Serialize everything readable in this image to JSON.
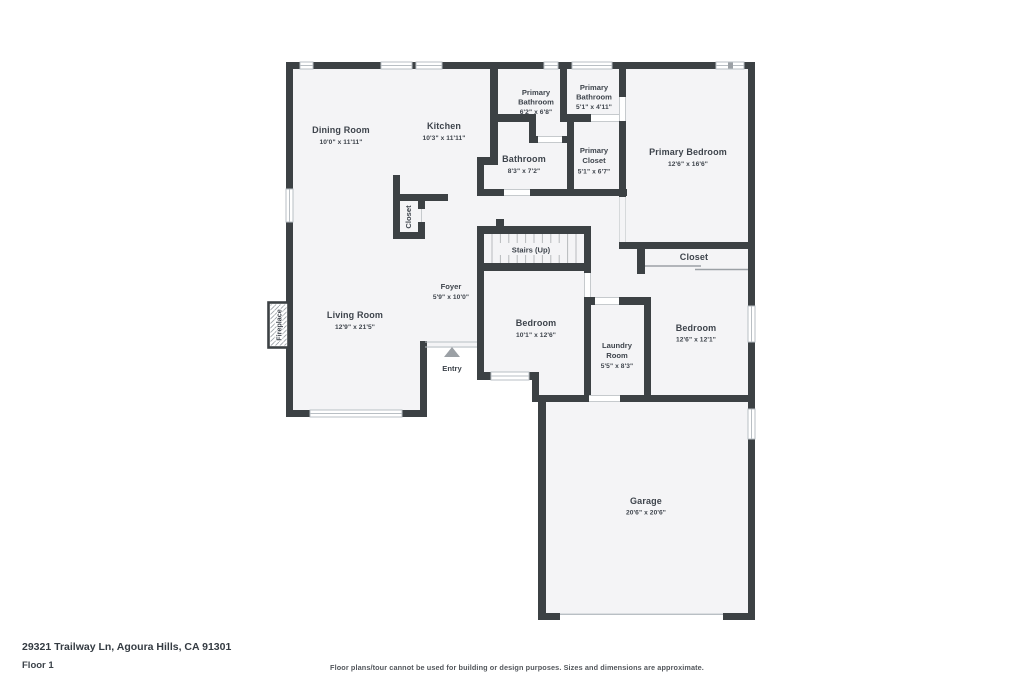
{
  "footer": {
    "address": "29321 Trailway Ln, Agoura Hills, CA 91301",
    "floor_label": "Floor 1",
    "disclaimer": "Floor plans/tour cannot be used for building or design purposes. Sizes and dimensions are approximate."
  },
  "colors": {
    "wall": "#3c4144",
    "floor": "#f4f4f6",
    "label_text": "#3e444c",
    "window_line": "#b9bfc4",
    "entry_arrow": "#9ba0a5"
  },
  "rooms": {
    "dining": {
      "name": "Dining Room",
      "dims": "10'0\" x 11'11\""
    },
    "kitchen": {
      "name": "Kitchen",
      "dims": "10'3\" x 11'11\""
    },
    "primary_bathroom_1": {
      "name_line1": "Primary",
      "name_line2": "Bathroom",
      "dims": "6'2\" x 6'8\""
    },
    "primary_bathroom_2": {
      "name_line1": "Primary",
      "name_line2": "Bathroom",
      "dims": "5'1\" x 4'11\""
    },
    "bathroom": {
      "name": "Bathroom",
      "dims": "8'3\" x 7'2\""
    },
    "primary_closet": {
      "name_line1": "Primary",
      "name_line2": "Closet",
      "dims": "5'1\" x 6'7\""
    },
    "primary_bedroom": {
      "name": "Primary Bedroom",
      "dims": "12'6\" x 16'6\""
    },
    "kitchen_closet": {
      "name": "Closet"
    },
    "stairs": {
      "name": "Stairs (Up)"
    },
    "bedroom_closet": {
      "name": "Closet"
    },
    "foyer": {
      "name": "Foyer",
      "dims": "5'9\" x 10'0\""
    },
    "living": {
      "name": "Living Room",
      "dims": "12'9\" x 21'5\""
    },
    "bedroom_1": {
      "name": "Bedroom",
      "dims": "10'1\" x 12'6\""
    },
    "laundry": {
      "name_line1": "Laundry",
      "name_line2": "Room",
      "dims": "5'5\" x 8'3\""
    },
    "bedroom_2": {
      "name": "Bedroom",
      "dims": "12'6\" x 12'1\""
    },
    "entry": {
      "name": "Entry"
    },
    "garage": {
      "name": "Garage",
      "dims": "20'6\" x 20'6\""
    },
    "fireplace": {
      "name": "Fireplace"
    }
  }
}
